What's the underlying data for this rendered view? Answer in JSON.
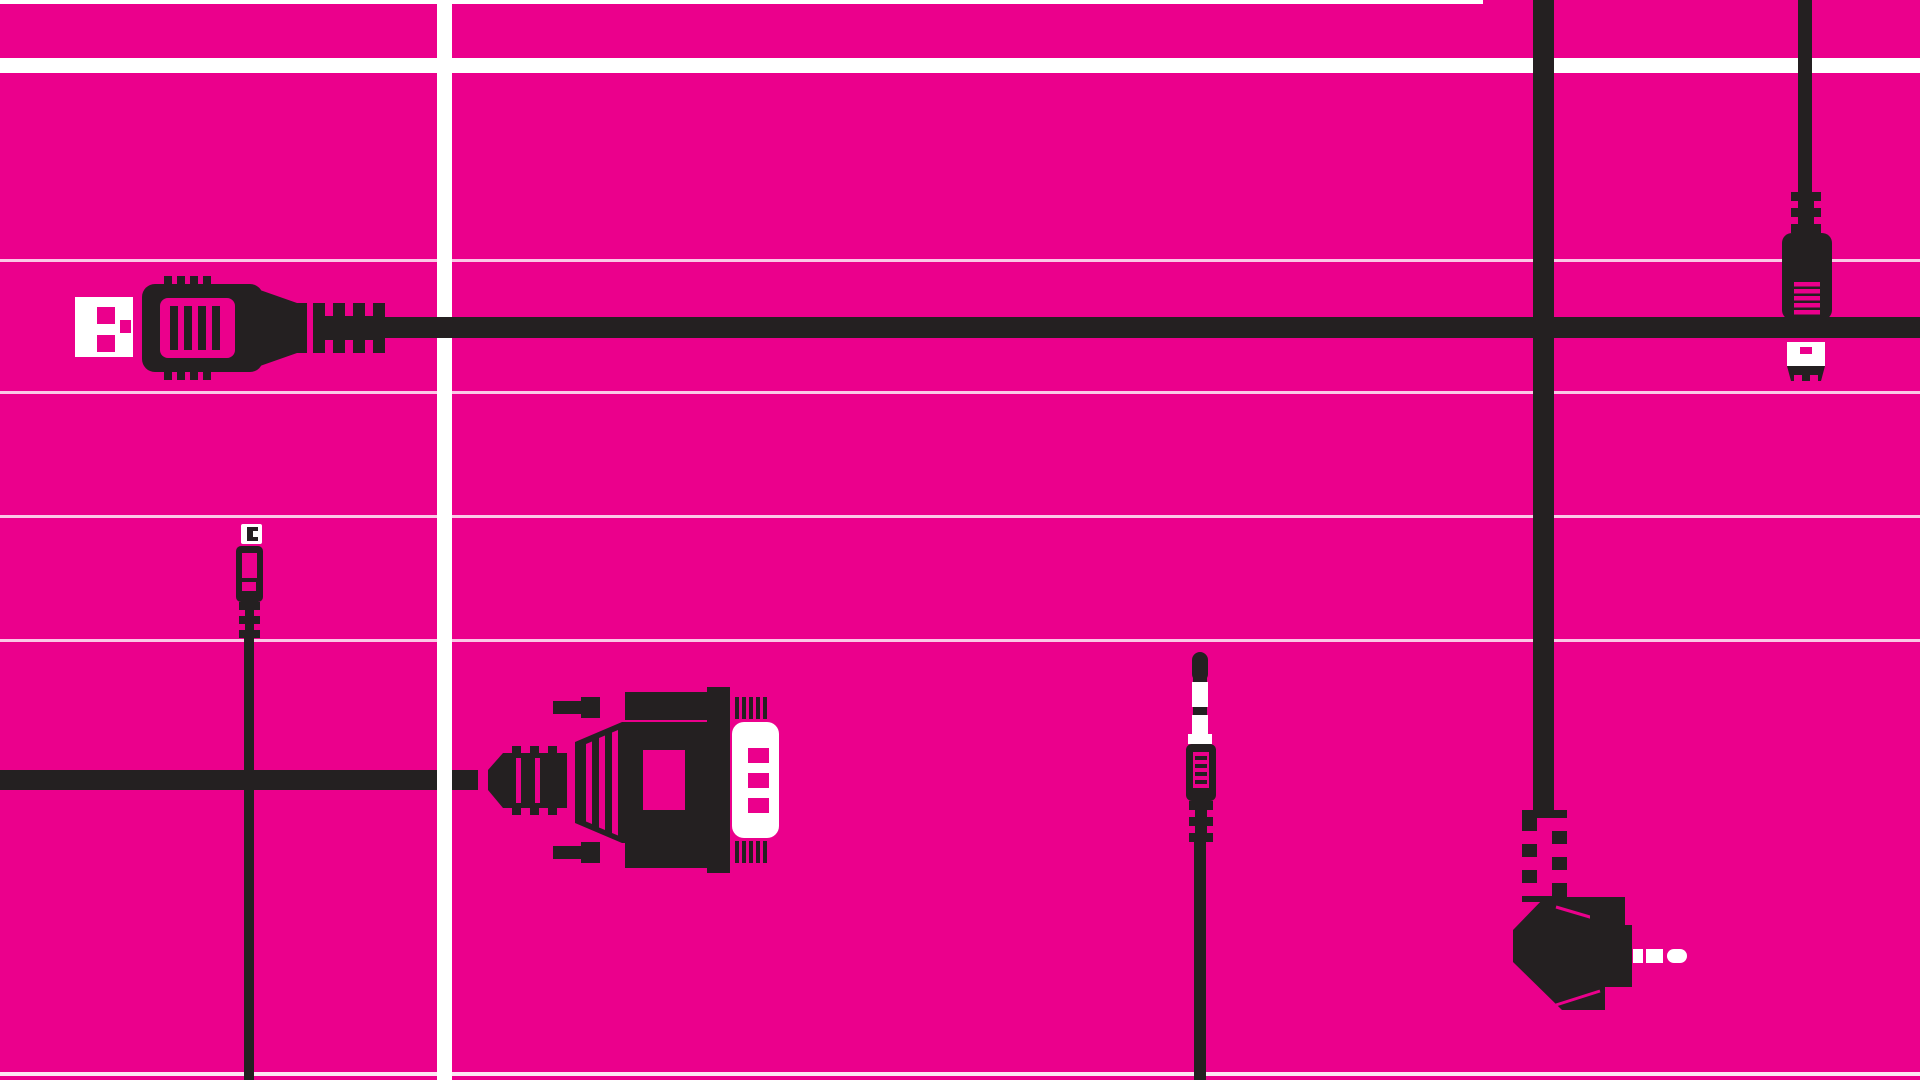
{
  "scene": {
    "title": "Cables and connectors illustration",
    "description": "Flat vector illustration of black cable plugs on a magenta background with a white grid of lines"
  },
  "palette": {
    "background": "#EB008C",
    "ink": "#242021",
    "paper": "#FFFFFF",
    "thin_line_opacity": 0.78
  },
  "grid": {
    "horizontal_thin_lines_y": [
      0,
      259,
      391,
      515,
      639,
      1072
    ],
    "horizontal_band_y": 58,
    "vertical_bar_x": 437
  },
  "objects": [
    {
      "id": "usb-a-plug",
      "label": "USB Type-A plug with horizontal cable"
    },
    {
      "id": "mini-usb-plug-left",
      "label": "Mini-USB plug pointing up with vertical cable"
    },
    {
      "id": "vga-serial-plug",
      "label": "DB9 VGA serial plug with thumbscrews and white D-sub shell"
    },
    {
      "id": "audio-jack-plug",
      "label": "3.5mm TRRS audio jack plug with vertical cable"
    },
    {
      "id": "micro-usb-plug-right",
      "label": "Micro-USB plug pointing down on vertical cable"
    },
    {
      "id": "right-angle-power-plug",
      "label": "Right-angle DC power plug with zigzag strain relief and white tip"
    }
  ]
}
